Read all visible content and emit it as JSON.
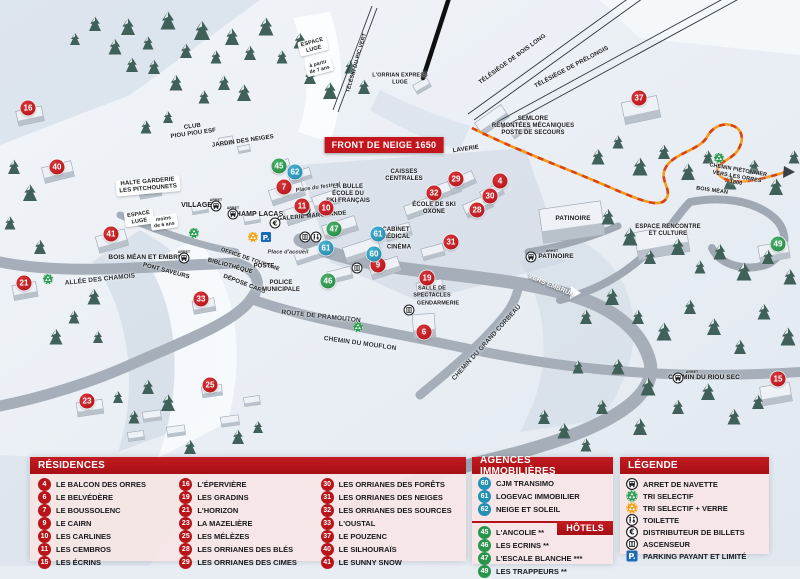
{
  "colors": {
    "marker_red": "#b81419",
    "marker_blue": "#2391b5",
    "marker_green": "#27964a",
    "header_red": "#b51318",
    "panel_pink": "#f6e5e5",
    "path_orange": "#f59a1d",
    "parking_blue": "#1b6ab5"
  },
  "front_banner": {
    "label": "FRONT DE NEIGE 1650"
  },
  "map": {
    "markers": [
      {
        "n": "16",
        "t": "res",
        "x": 28,
        "y": 108
      },
      {
        "n": "40",
        "t": "res",
        "x": 57,
        "y": 167
      },
      {
        "n": "41",
        "t": "res",
        "x": 111,
        "y": 234
      },
      {
        "n": "21",
        "t": "res",
        "x": 24,
        "y": 283
      },
      {
        "n": "23",
        "t": "res",
        "x": 87,
        "y": 401
      },
      {
        "n": "25",
        "t": "res",
        "x": 210,
        "y": 385
      },
      {
        "n": "33",
        "t": "res",
        "x": 201,
        "y": 299
      },
      {
        "n": "7",
        "t": "res",
        "x": 284,
        "y": 187
      },
      {
        "n": "11",
        "t": "res",
        "x": 302,
        "y": 206
      },
      {
        "n": "10",
        "t": "res",
        "x": 326,
        "y": 208
      },
      {
        "n": "9",
        "t": "res",
        "x": 378,
        "y": 265
      },
      {
        "n": "19",
        "t": "res",
        "x": 427,
        "y": 278
      },
      {
        "n": "6",
        "t": "res",
        "x": 424,
        "y": 332
      },
      {
        "n": "31",
        "t": "res",
        "x": 451,
        "y": 242
      },
      {
        "n": "32",
        "t": "res",
        "x": 434,
        "y": 193
      },
      {
        "n": "29",
        "t": "res",
        "x": 456,
        "y": 179
      },
      {
        "n": "28",
        "t": "res",
        "x": 477,
        "y": 210
      },
      {
        "n": "30",
        "t": "res",
        "x": 490,
        "y": 196
      },
      {
        "n": "4",
        "t": "res",
        "x": 500,
        "y": 181
      },
      {
        "n": "37",
        "t": "res",
        "x": 639,
        "y": 98
      },
      {
        "n": "15",
        "t": "res",
        "x": 778,
        "y": 379
      },
      {
        "n": "62",
        "t": "ag",
        "x": 295,
        "y": 172
      },
      {
        "n": "61",
        "t": "ag",
        "x": 378,
        "y": 234
      },
      {
        "n": "61",
        "t": "ag",
        "x": 326,
        "y": 248
      },
      {
        "n": "60",
        "t": "ag",
        "x": 374,
        "y": 254
      },
      {
        "n": "45",
        "t": "hot",
        "x": 279,
        "y": 166
      },
      {
        "n": "47",
        "t": "hot",
        "x": 334,
        "y": 229
      },
      {
        "n": "46",
        "t": "hot",
        "x": 328,
        "y": 281
      },
      {
        "n": "49",
        "t": "hot",
        "x": 778,
        "y": 244
      }
    ],
    "icons": [
      {
        "icon": "bus",
        "x": 216,
        "y": 206
      },
      {
        "icon": "bus",
        "x": 233,
        "y": 214
      },
      {
        "icon": "bus",
        "x": 184,
        "y": 258
      },
      {
        "icon": "bus",
        "x": 531,
        "y": 257
      },
      {
        "icon": "bus",
        "x": 678,
        "y": 378
      },
      {
        "icon": "recycle-green",
        "x": 194,
        "y": 233
      },
      {
        "icon": "recycle-green",
        "x": 48,
        "y": 279
      },
      {
        "icon": "recycle-green",
        "x": 358,
        "y": 327
      },
      {
        "icon": "recycle-green",
        "x": 719,
        "y": 158
      },
      {
        "icon": "recycle-yellow",
        "x": 253,
        "y": 237
      },
      {
        "icon": "parking",
        "x": 266,
        "y": 237
      },
      {
        "icon": "euro",
        "x": 275,
        "y": 223
      },
      {
        "icon": "toilet",
        "x": 305,
        "y": 210
      },
      {
        "icon": "elevator",
        "x": 305,
        "y": 237
      },
      {
        "icon": "toilet",
        "x": 316,
        "y": 237
      },
      {
        "icon": "elevator",
        "x": 357,
        "y": 268
      },
      {
        "icon": "elevator",
        "x": 409,
        "y": 310
      }
    ],
    "labels": [
      {
        "text": "ESPACE\nLUGE",
        "x": 313,
        "y": 46,
        "rot": -15,
        "variant": "sign",
        "size": 5.5
      },
      {
        "text": "à partir\nde 7 ans",
        "x": 319,
        "y": 67,
        "rot": -15,
        "variant": "sign",
        "size": 5
      },
      {
        "text": "TÉLÉSKI DU PIC VERT",
        "x": 357,
        "y": 63,
        "rot": -74,
        "size": 5.5
      },
      {
        "text": "L'ORRIAN EXPRESS\nLUGE",
        "x": 400,
        "y": 79,
        "size": 5.5
      },
      {
        "text": "TÉLÉSIÈGE DE BOIS LONG",
        "x": 513,
        "y": 60,
        "rot": -36,
        "size": 6
      },
      {
        "text": "TÉLÉSIÈGE DE PRÉLONGIS",
        "x": 572,
        "y": 68,
        "rot": -28,
        "size": 6
      },
      {
        "text": "SEMLORE\nREMONTÉES MÉCANIQUES\nPOSTE DE SECOURS",
        "x": 533,
        "y": 127,
        "size": 6
      },
      {
        "text": "CLUB\nPIOU PIOU ESF",
        "x": 193,
        "y": 131,
        "rot": -8,
        "size": 6
      },
      {
        "text": "JARDIN DES NEIGES",
        "x": 243,
        "y": 142,
        "rot": -8,
        "size": 6
      },
      {
        "text": "HALTE GARDERIE\nLES PITCHOUNETS",
        "x": 148,
        "y": 186,
        "rot": -5,
        "variant": "sign",
        "size": 6
      },
      {
        "text": "VILLAGES",
        "x": 199,
        "y": 206,
        "size": 7
      },
      {
        "text": "CHAMP LACAS",
        "x": 257,
        "y": 215,
        "size": 7
      },
      {
        "text": "ESPACE\nLUGE",
        "x": 139,
        "y": 218,
        "rot": -8,
        "variant": "sign",
        "size": 5.5
      },
      {
        "text": "moins\nde 6 ans",
        "x": 164,
        "y": 222,
        "rot": -8,
        "variant": "sign",
        "size": 5
      },
      {
        "text": "LAVERIE",
        "x": 466,
        "y": 150,
        "rot": -8,
        "size": 6
      },
      {
        "text": "CAISSES\nCENTRALES",
        "x": 404,
        "y": 176,
        "size": 6
      },
      {
        "text": "LA BULLE\nÉCOLE DU\nSKI FRANÇAIS",
        "x": 348,
        "y": 195,
        "size": 6
      },
      {
        "text": "Place du festival",
        "x": 318,
        "y": 188,
        "rot": -8,
        "variant": "ita",
        "size": 5.5
      },
      {
        "text": "GALERIE MARCHANDE",
        "x": 312,
        "y": 217,
        "rot": -5,
        "size": 6
      },
      {
        "text": "ÉCOLE DE SKI\nOXONE",
        "x": 434,
        "y": 209,
        "size": 6
      },
      {
        "text": "CABINET\nMÉDICAL",
        "x": 396,
        "y": 234,
        "size": 6
      },
      {
        "text": "CINÉMA",
        "x": 399,
        "y": 248,
        "size": 6
      },
      {
        "text": "Place d'accueil",
        "x": 288,
        "y": 253,
        "variant": "ita",
        "size": 5.5
      },
      {
        "text": "BOIS MÉAN ET EMBRUN",
        "x": 148,
        "y": 258,
        "size": 6.5
      },
      {
        "text": "PONT SAVEURS",
        "x": 166,
        "y": 272,
        "rot": 15,
        "size": 6
      },
      {
        "text": "ALLÉE DES CHAMOIS",
        "x": 100,
        "y": 280,
        "rot": -6,
        "variant": "road",
        "size": 6.5
      },
      {
        "text": "BIBLIOTHÈQUE",
        "x": 230,
        "y": 267,
        "rot": 15,
        "size": 6
      },
      {
        "text": "OFFICE DE TOURISME",
        "x": 250,
        "y": 260,
        "rot": 19,
        "size": 5.5
      },
      {
        "text": "POSTE",
        "x": 264,
        "y": 267,
        "size": 6
      },
      {
        "text": "DÉPOSE CARS",
        "x": 244,
        "y": 285,
        "rot": 21,
        "size": 6
      },
      {
        "text": "POLICE\nMUNICIPALE",
        "x": 281,
        "y": 287,
        "size": 6
      },
      {
        "text": "ROUTE DE PRAMOUTON",
        "x": 321,
        "y": 317,
        "rot": 6,
        "variant": "road",
        "size": 6.5
      },
      {
        "text": "CHEMIN DU MOUFLON",
        "x": 360,
        "y": 344,
        "rot": 8,
        "variant": "road",
        "size": 6.5
      },
      {
        "text": "CHEMIN DU GRAND CORBEAU",
        "x": 487,
        "y": 343,
        "rot": -48,
        "variant": "road",
        "size": 6.5
      },
      {
        "text": "VERS EMBRUN",
        "x": 551,
        "y": 286,
        "rot": 23,
        "variant": "white",
        "size": 6.5
      },
      {
        "text": "SALLE DE\nSPECTACLES",
        "x": 432,
        "y": 292,
        "size": 5.5
      },
      {
        "text": "GENDARMERIE",
        "x": 438,
        "y": 304,
        "size": 5.5
      },
      {
        "text": "PATINOIRE",
        "x": 573,
        "y": 219,
        "size": 6.5
      },
      {
        "text": "PATINOIRE",
        "x": 556,
        "y": 257,
        "size": 6.5
      },
      {
        "text": "ESPACE RENCONTRE\nET CULTURE",
        "x": 668,
        "y": 231,
        "size": 6
      },
      {
        "text": "CHEMIN PIÉTONNIER\nVERS LES ORRES 1800",
        "x": 737,
        "y": 177,
        "rot": 10,
        "size": 5.5
      },
      {
        "text": "BOIS MÉAN",
        "x": 712,
        "y": 191,
        "rot": 8,
        "size": 5.5
      },
      {
        "text": "CHEMIN DU RIOU SEC",
        "x": 704,
        "y": 378,
        "size": 6.5
      },
      {
        "text": "ARRET",
        "x": 216,
        "y": 200,
        "variant": "tiny"
      },
      {
        "text": "ARRET",
        "x": 233,
        "y": 208,
        "variant": "tiny"
      },
      {
        "text": "ARRET",
        "x": 184,
        "y": 252,
        "variant": "tiny"
      },
      {
        "text": "ARRET",
        "x": 552,
        "y": 251,
        "variant": "tiny"
      },
      {
        "text": "ARRET",
        "x": 692,
        "y": 372,
        "variant": "tiny"
      }
    ]
  },
  "panels": {
    "residences": {
      "header": "RÉSIDENCES",
      "items": [
        {
          "n": "4",
          "label": "LE BALCON DES ORRES"
        },
        {
          "n": "6",
          "label": "LE BELVÉDÈRE"
        },
        {
          "n": "7",
          "label": "LE BOUSSOLENC"
        },
        {
          "n": "9",
          "label": "LE CAIRN"
        },
        {
          "n": "10",
          "label": "LES CARLINES"
        },
        {
          "n": "11",
          "label": "LES CEMBROS"
        },
        {
          "n": "15",
          "label": "LES ÉCRINS"
        },
        {
          "n": "16",
          "label": "L'ÉPERVIÈRE"
        },
        {
          "n": "19",
          "label": "LES GRADINS"
        },
        {
          "n": "21",
          "label": "L'HORIZON"
        },
        {
          "n": "23",
          "label": "LA MAZELIÈRE"
        },
        {
          "n": "25",
          "label": "LES MÉLÈZES"
        },
        {
          "n": "28",
          "label": "LES ORRIANES DES BLÉS"
        },
        {
          "n": "29",
          "label": "LES ORRIANES DES CIMES"
        },
        {
          "n": "30",
          "label": "LES ORRIANES DES FORÊTS"
        },
        {
          "n": "31",
          "label": "LES ORRIANES DES NEIGES"
        },
        {
          "n": "32",
          "label": "LES ORRIANES DES SOURCES"
        },
        {
          "n": "33",
          "label": "L'OUSTAL"
        },
        {
          "n": "37",
          "label": "LE POUZENC"
        },
        {
          "n": "40",
          "label": "LE SILHOURAÏS"
        },
        {
          "n": "41",
          "label": "LE SUNNY SNOW"
        }
      ]
    },
    "agences": {
      "header": "AGENCES IMMOBILIÈRES",
      "items": [
        {
          "n": "60",
          "label": "CJM TRANSIMO"
        },
        {
          "n": "61",
          "label": "LOGEVAC IMMOBILIER"
        },
        {
          "n": "62",
          "label": "NEIGE ET SOLEIL"
        }
      ]
    },
    "hotels": {
      "header": "HÔTELS",
      "items": [
        {
          "n": "45",
          "label": "L'ANCOLIE **"
        },
        {
          "n": "46",
          "label": "LES ECRINS **"
        },
        {
          "n": "47",
          "label": "L'ESCALE BLANCHE ***"
        },
        {
          "n": "49",
          "label": "LES TRAPPEURS **"
        }
      ]
    },
    "legende": {
      "header": "LÉGENDE",
      "items": [
        {
          "icon": "bus",
          "label": "ARRET DE NAVETTE"
        },
        {
          "icon": "recycle-green",
          "label": "TRI SELECTIF"
        },
        {
          "icon": "recycle-yellow",
          "label": "TRI SELECTIF + VERRE"
        },
        {
          "icon": "toilet",
          "label": "TOILETTE"
        },
        {
          "icon": "euro",
          "label": "DISTRIBUTEUR DE BILLETS"
        },
        {
          "icon": "elevator",
          "label": "ASCENSEUR"
        },
        {
          "icon": "parking",
          "label": "PARKING PAYANT ET LIMITÉ"
        }
      ]
    }
  }
}
